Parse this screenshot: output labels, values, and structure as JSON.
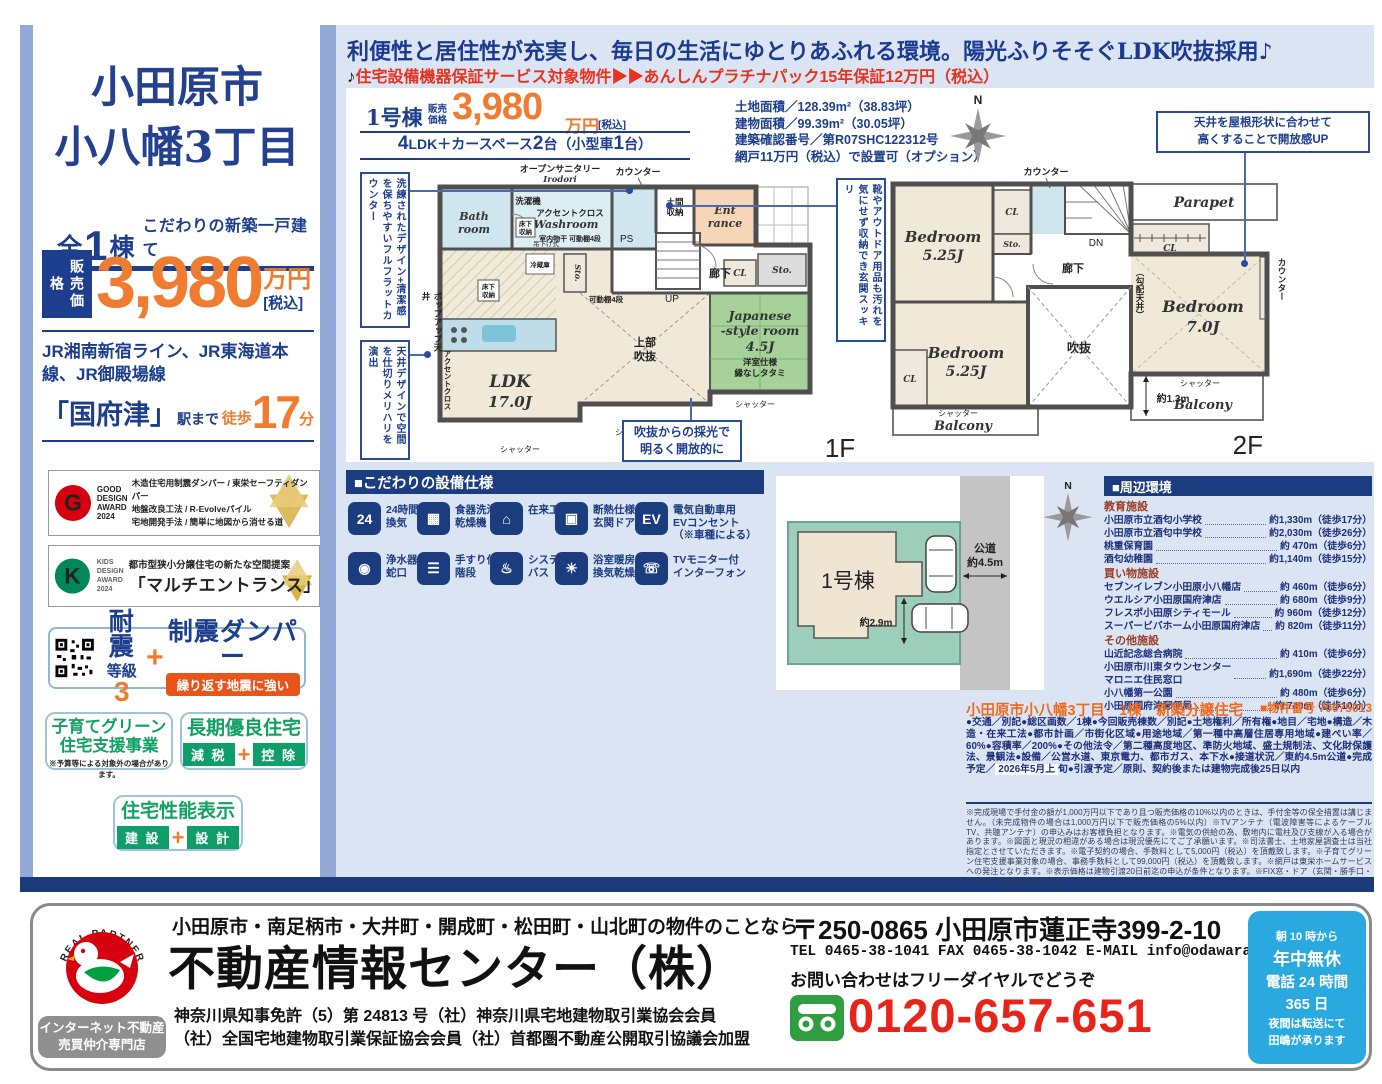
{
  "colors": {
    "navy": "#1c3e8c",
    "orange": "#ef7c30",
    "red": "#e8321e",
    "green": "#13a065",
    "page_blue": "#dbe4f3",
    "header_bar": "#1c3c80",
    "phone_red": "#e8231a",
    "hours_blue": "#2aa8e0"
  },
  "sidebar": {
    "title1": "小田原市",
    "title2": "小八幡3丁目",
    "total": {
      "a": "全",
      "n": "1",
      "b": "棟",
      "tagline": "こだわりの新築一戸建て"
    },
    "price": {
      "label": "販売価格",
      "amount": "3,980",
      "unit": "万円",
      "tax": "[税込]"
    },
    "rail": "JR湘南新宿ライン、JR東海道本線、JR御殿場線",
    "station": {
      "name": "「国府津」",
      "suffix": "駅まで",
      "walk_label": "徒歩",
      "walk_min": "17",
      "walk_unit": "分"
    },
    "good_design": {
      "logo_g": "G",
      "logo_text": "GOOD\nDESIGN\nAWARD\n2024",
      "line1": "木造住宅用制震ダンパー / 東栄セーフティダンパー",
      "line2": "地盤改良工法 / R-Evolveパイル",
      "line3": "宅地開発手法 / 簡単に地図から消せる道"
    },
    "kids_design": {
      "logo_k": "K",
      "logo_text": "KIDS\nDESIGN\nAWARD\n2024",
      "line1": "都市型狭小分譲住宅の新たな空間提案",
      "line2": "「マルチエントランス」"
    },
    "quake": {
      "taishin": "耐震",
      "grade": "等級",
      "grade_n": "3",
      "plus": "+",
      "seishin": "制震ダンパー",
      "pill": "繰り返す地震に強い"
    },
    "kosodate": {
      "line1": "子育てグリーン",
      "line2": "住宅支援事業",
      "note": "※予算等による対象外の場合があります。"
    },
    "choki": {
      "title": "長期優良住宅",
      "tag1": "減 税",
      "plus": "+",
      "tag2": "控 除"
    },
    "seinou": {
      "title": "住宅性能表示",
      "tag1": "建 設",
      "plus": "+",
      "tag2": "設 計"
    }
  },
  "header": {
    "headline": "利便性と居住性が充実し、毎日の生活にゆとりあふれる環境。陽光ふりそそぐLDK吹抜採用♪",
    "note_mark": "♪",
    "warranty": "住宅設備機器保証サービス対象物件▶▶あんしんプラチナパック15年保証12万円（税込）"
  },
  "price_box": {
    "name": "1号棟",
    "price_label": "販売\n価格",
    "amount": "3,980",
    "unit": "万円",
    "tax": "[税込]",
    "layout_pre": "4",
    "layout_mid": "LDK＋カースペース",
    "layout_n2": "2",
    "layout_mid2": "台（小型車",
    "layout_n3": "1",
    "layout_end": "台）",
    "land_info": "土地面積／128.39m²（38.83坪）\n建物面積／99.39m²（30.05坪）\n建築確認番号／第R07SHC122312号\n網戸11万円（税込）で設置可（オプション）"
  },
  "floorplan1": {
    "callout_left1": "洗練されたデザイン+清潔感を保ちやすいフルフラットカウンター",
    "callout_left2": "天井デザインで空間を仕切りメリハリを演出",
    "callout_right": "靴やアウトドア用品も汚れを気にせず収納でき玄関スッキリ",
    "callout_bottom": "吹抜からの採光で\n明るく開放的に",
    "popup_ceiling": "ポップアップ天井",
    "accent_v": "アクセントクロス",
    "labels": {
      "open_sanitary": "オープンサニタリー",
      "irodori": "Irodori",
      "counter": "カウンター",
      "washer": "洗濯機",
      "accent": "アクセントクロス",
      "washroom": "Washroom",
      "bath1": "Bath",
      "bath2": "room",
      "underfloor1": "床下",
      "underfloor2": "収納",
      "monohoshi": "室内物干 可動棚4段",
      "tsurisage": "吊下げ式",
      "ps": "PS",
      "doma1": "土間",
      "doma2": "収納",
      "ent1": "Ent",
      "ent2": "rance",
      "up": "UP",
      "hall": "廊下",
      "cl": "CL",
      "sto": "Sto.",
      "shelf": "可動棚4段",
      "fridge": "冷蔵庫",
      "ldk1": "LDK",
      "ldk2": "17.0J",
      "void1": "上部",
      "void2": "吹抜",
      "jp1": "Japanese",
      "jp2": "-style room",
      "jp3": "4.5J",
      "jp4": "洋室仕様",
      "jp5": "縁なしタタミ",
      "shutter": "シャッター",
      "floor": "1F"
    }
  },
  "floorplan2": {
    "callout_top": "天井を屋根形状に合わせて\n高くすることで開放感UP",
    "slope": "（勾配天井）",
    "counter_right": "カウンター",
    "labels": {
      "counter": "カウンター",
      "parapet": "Parapet",
      "cl": "CL",
      "sto": "Sto.",
      "dn": "DN",
      "hall": "廊下",
      "bed1a": "Bedroom",
      "bed1b": "5.25J",
      "bed2a": "Bedroom",
      "bed2b": "5.25J",
      "bed3a": "Bedroom",
      "bed3b": "7.0J",
      "void": "吹抜",
      "balcony": "Balcony",
      "depth": "約1.3m",
      "shutter": "シャッター",
      "floor": "2F"
    }
  },
  "compass": {
    "n": "N"
  },
  "specs": {
    "header": "■こだわりの設備仕様",
    "items": [
      {
        "glyph": "24",
        "label": "24時間\n換気"
      },
      {
        "glyph": "▦",
        "label": "食器洗浄\n乾燥機"
      },
      {
        "glyph": "⌂",
        "label": "在来工法"
      },
      {
        "glyph": "▣",
        "label": "断熱仕様\n玄関ドア"
      },
      {
        "glyph": "EV",
        "label": "電気自動車用\nEVコンセント\n（※車種による）"
      },
      {
        "glyph": "◉",
        "label": "浄水器\n蛇口"
      },
      {
        "glyph": "☰",
        "label": "手すり付\n階段"
      },
      {
        "glyph": "♨",
        "label": "システム\nバス"
      },
      {
        "glyph": "☀",
        "label": "浴室暖房\n換気乾燥機"
      },
      {
        "glyph": "☏",
        "label": "TVモニター付\nインターフォン"
      }
    ]
  },
  "siteplan": {
    "building": "1号棟",
    "road1": "公道",
    "road2": "約4.5m",
    "width": "約2.9m"
  },
  "surroundings": {
    "header": "■周辺環境",
    "groups": [
      {
        "title": "教育施設",
        "items": [
          {
            "name": "小田原市立酒匂小学校",
            "value": "約1,330m（徒歩17分）"
          },
          {
            "name": "小田原市立酒匂中学校",
            "value": "約2,030m（徒歩26分）"
          },
          {
            "name": "桃重保育園",
            "value": "約 470m（徒歩6分）"
          },
          {
            "name": "酒匂幼稚園",
            "value": "約1,140m（徒歩15分）"
          }
        ]
      },
      {
        "title": "買い物施設",
        "items": [
          {
            "name": "セブンイレブン小田原小八幡店",
            "value": "約 460m（徒歩6分）"
          },
          {
            "name": "ウエルシア小田原国府津店",
            "value": "約 680m（徒歩9分）"
          },
          {
            "name": "フレスポ小田原シティモール",
            "value": "約 960m（徒歩12分）"
          },
          {
            "name": "スーパービバホーム小田原国府津店",
            "value": "約 820m（徒歩11分）"
          }
        ]
      },
      {
        "title": "その他施設",
        "items": [
          {
            "name": "山近記念総合病院",
            "value": "約 410m（徒歩6分）"
          },
          {
            "name": "小田原市川東タウンセンター\nマロニエ住民窓口",
            "value": "約1,690m（徒歩22分）"
          },
          {
            "name": "小八幡第一公園",
            "value": "約 480m（徒歩6分）"
          },
          {
            "name": "小田原国府津郵便局",
            "value": "約 740m（徒歩10分）"
          }
        ]
      }
    ]
  },
  "property": {
    "title": "小田原市小八幡3丁目　1棟　新築分譲住宅",
    "number": "■物件番号 70075013",
    "body1": "●交通／別記●総区画数／1棟●今回販売棟数／別記●土地権利／所有権●地目／宅地●構造／木造・在来工法●都市計画／市街化区域●用途地域／第一種中高層住居専用地域●建ぺい率／60%●容積率／200%●その他法令／第二種高度地区、準防火地域、盛土規制法、文化財保護法、景観法●設備／公営水道、東京電力、都市ガス、本下水●接道状況／東約4.5m公道●完成予定／",
    "highlight": "2026年5月上",
    "body2": "旬●引渡予定／原則、契約後または建物完成後25日以内"
  },
  "fine_print": "※完成現場で手付金の額が1,000万円以下であり且つ販売価格の10%以内のときは、手付金等の保全措置は講じません。（未完成物件の場合は1,000万円以下で販売価格の5%以内）※TVアンテナ（電波障害等によるケーブルTV、共聴アンテナ）の申込みはお客様負担となります。※電気の供給の為、敷地内に電柱及び支線が入る場合があります。※図面と現況の相違がある場合は現況優先にてご了承願います。※司法書士、土地家屋調査士は当社指定とさせていただきます。※電子契約の場合、手数料として5,000円（税込）を頂戴致します。※子育てグリーン住宅支援事業対象の場合、事務手数料として99,000円（税込）を頂戴致します。※網戸は東栄ホームサービスへの発注となります。※表示価格は建物引渡20日前迄の申込が条件となります。※FIX窓・ドア（玄関・勝手口・テラス）は対象外となります。",
  "footer": {
    "real_partner": "REAL PARTNER",
    "internet_badge": "インターネット不動産\n売買仲介専門店",
    "area_line": "小田原市・南足柄市・大井町・開成町・松田町・山北町の物件のことなら",
    "company": "不動産情報センター（株）",
    "license1": "神奈川県知事免許（5）第 24813 号（社）神奈川県宅地建物取引業協会会員",
    "license2": "（社）全国宅地建物取引業保証協会会員（社）首都圏不動産公開取引協議会加盟",
    "address": "〒250-0865 小田原市蓮正寺399-2-10",
    "tel_line": "TEL 0465-38-1041 FAX 0465-38-1042 E-MAIL info@odawara1.co.jp",
    "cta": "お問い合わせはフリーダイヤルでどうぞ",
    "phone": "0120-657-651",
    "hours": {
      "l1": "朝 10 時から",
      "l2": "年中無休",
      "l3": "電話 24 時間",
      "l4": "365 日",
      "l5": "夜間は転送にて",
      "l6": "田嶋が承ります"
    }
  }
}
